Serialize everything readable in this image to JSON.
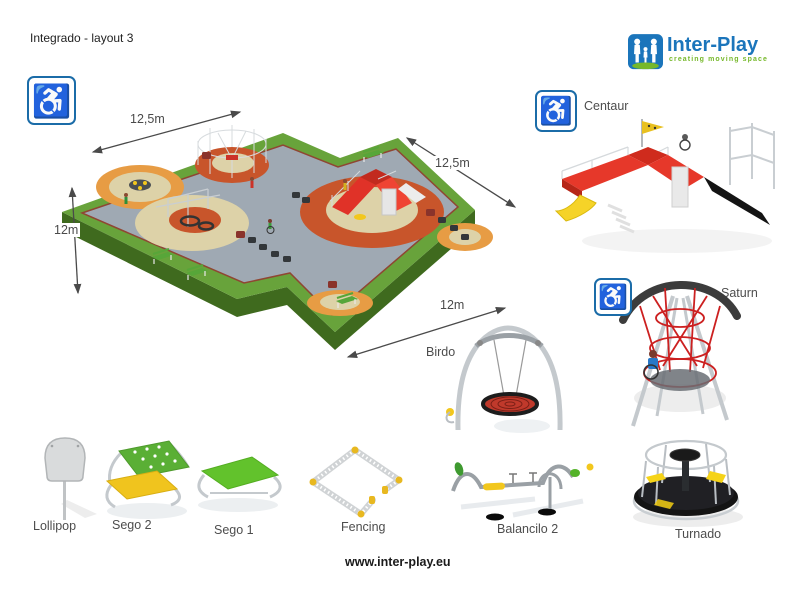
{
  "header": {
    "title": "Integrado - layout 3"
  },
  "logo": {
    "brand": "Inter-Play",
    "tagline": "creating moving space"
  },
  "plan": {
    "dimensions": {
      "top": "12,5m",
      "left": "12m",
      "right": "12,5m",
      "bottom": "12m"
    }
  },
  "products": [
    {
      "name": "Centaur",
      "accessible": true
    },
    {
      "name": "Saturn",
      "accessible": true
    },
    {
      "name": "Birdo",
      "accessible": false
    },
    {
      "name": "Lollipop",
      "accessible": false
    },
    {
      "name": "Sego 2",
      "accessible": false
    },
    {
      "name": "Sego 1",
      "accessible": false
    },
    {
      "name": "Fencing",
      "accessible": false
    },
    {
      "name": "Balancilo 2",
      "accessible": false
    },
    {
      "name": "Turnado",
      "accessible": false
    }
  ],
  "footer": {
    "website": "www.inter-play.eu"
  },
  "icons": {
    "accessibility": "wheelchair"
  },
  "colors": {
    "brand_blue": "#1b75bb",
    "brand_green": "#76b82a",
    "grass": "#68a33b",
    "rubber_surface": "#9fa9b3",
    "circle_orange": "#e79c44",
    "circle_red": "#c8552b",
    "circle_beige": "#ddd2a8",
    "equipment_red": "#e03228",
    "label_gray": "#4d4d4d"
  }
}
